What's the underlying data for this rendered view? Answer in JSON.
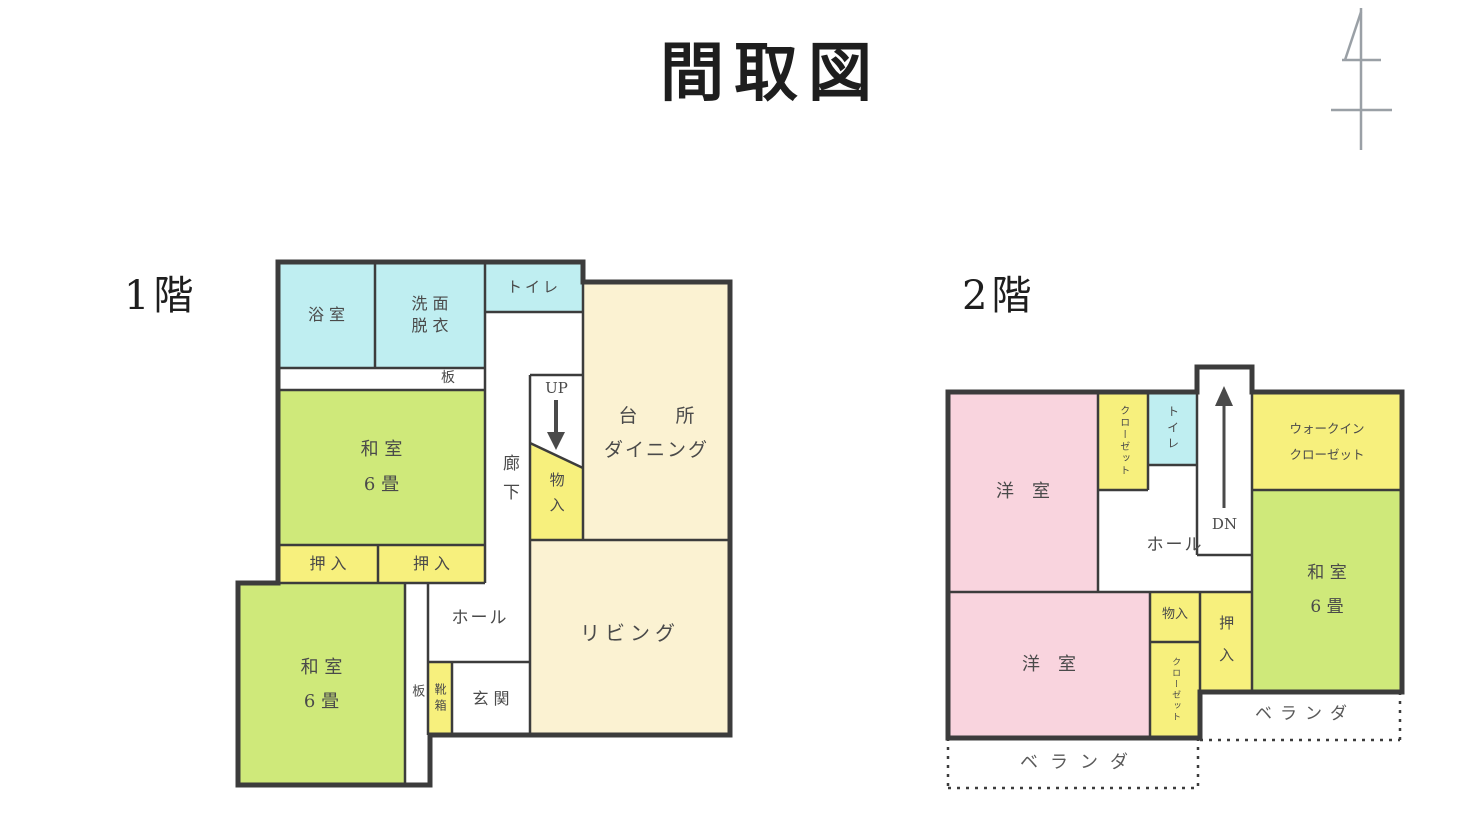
{
  "title": "間取図",
  "colors": {
    "cyan": "#bfeef1",
    "green": "#cfe97a",
    "yellow": "#f7f07d",
    "cream": "#fbf2d2",
    "pink": "#f9d4de",
    "wall": "#3c3c3c",
    "north": "#9aa0a6"
  },
  "floor1": {
    "label": "1階",
    "rooms": {
      "bath": "浴 室",
      "washroom": [
        "洗 面",
        "脱 衣"
      ],
      "toilet": "トイレ",
      "board_top": "板",
      "washitsu_upper": [
        "和 室",
        "6 畳"
      ],
      "closet_left": "押 入",
      "closet_right": "押 入",
      "corridor": "廊下",
      "stairs_up": "UP",
      "storage": "物入",
      "kitchen": [
        "台　　所",
        "ダイニング"
      ],
      "living": "リビング",
      "hall": "ホール",
      "entrance": "玄 関",
      "shoe_box": "靴箱",
      "board_side": "板",
      "washitsu_lower": [
        "和 室",
        "6 畳"
      ]
    }
  },
  "floor2": {
    "label": "2階",
    "rooms": {
      "western_upper": "洋　室",
      "closet_upper": "クローゼット",
      "toilet": "トイレ",
      "stairs_down": "DN",
      "walkin_closet": [
        "ウォークイン",
        "クローゼット"
      ],
      "washitsu": [
        "和 室",
        "6 畳"
      ],
      "hall": "ホール",
      "western_lower": "洋　室",
      "storage": "物入",
      "closet_lower": "クローゼット",
      "oshiire": "押 入",
      "veranda_right": "ベランダ",
      "veranda_bottom": "ベランダ"
    }
  }
}
